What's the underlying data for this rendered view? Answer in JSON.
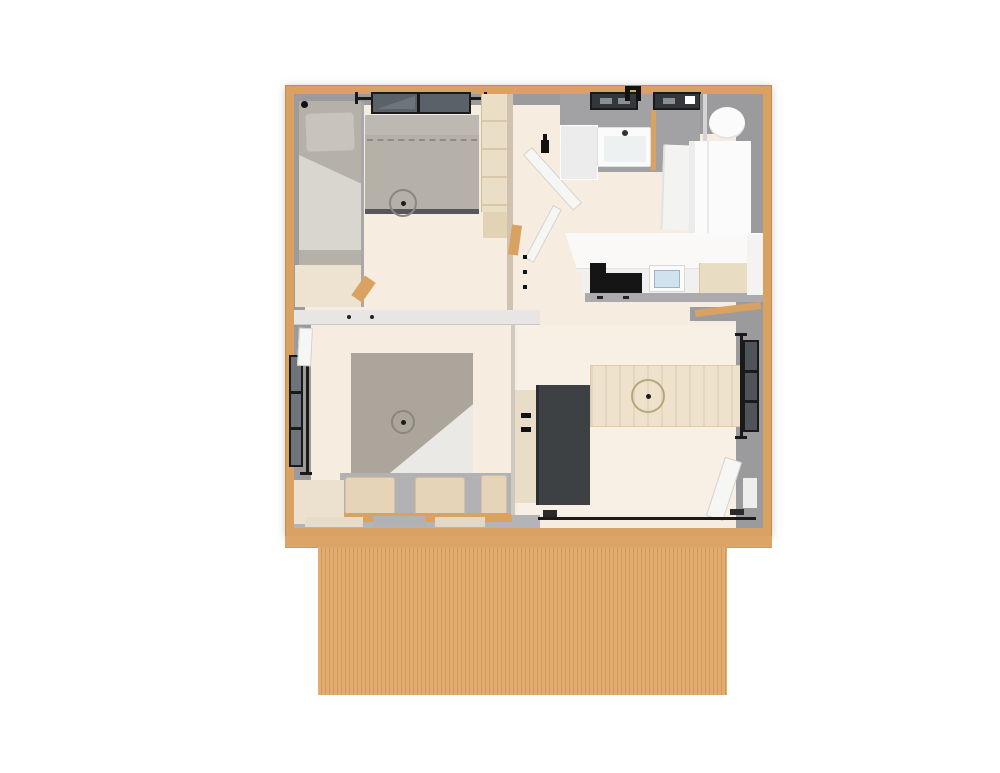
{
  "scene": {
    "type": "3d-floorplan-top-down-render",
    "description": "Top-down 3D rendered floor plan of a small two-bedroom cabin with bathroom, kitchen, living-dining area and a wooden plank deck along the front",
    "view": "top-down",
    "background": "#ffffff"
  },
  "palette": {
    "bg": "#ffffff",
    "wood-frame": "#d9a262",
    "wood-strip": "#dba567",
    "wood-deck": "#e2ac6e",
    "wood-deck-line": "#d09a5c",
    "wood-light": "#ebdec6",
    "floor-cream": "#f6ecdf",
    "floor-light": "#f8efe5",
    "wall-gray": "#9b9b9d",
    "wall-gray-light": "#b4b4b6",
    "divider-white": "#e7e6e4",
    "bed-gray": "#b5b0a8",
    "bed-gray-light": "#c8c4bd",
    "bed-sheet": "#d9d6d0",
    "taupe-bed": "#aca59c",
    "sheet-white": "#ebe9e5",
    "charcoal": "#3e4144",
    "black": "#1a1a1a",
    "glass-dark": "#5a6169",
    "glass-window": "#33373c",
    "glass-side": "#6e747a",
    "white-fixture": "#fbfbfb",
    "fixture-shade": "#ececea",
    "door-white": "#f6f6f4",
    "tan-pillow": "#e5d4b8",
    "tan-pillow-edge": "#d3c0a0",
    "sink-blue": "#cfe2ed",
    "counter-white": "#faf9f7",
    "counter-base": "#ababad",
    "light-ring": "#8b8680",
    "table-wood": "#eee2cc",
    "table-ring": "#b7a77f",
    "bed-frame-dark": "#54575b"
  },
  "building": {
    "deck": {
      "material": "wood",
      "planks": "vertical"
    },
    "rooms": [
      {
        "id": "bedroom-1",
        "position": "top-left",
        "furniture": [
          "single-bed",
          "double-bed",
          "window-above-bed",
          "wardrobe",
          "dresser-bench",
          "ceiling-light",
          "wall-lamp"
        ]
      },
      {
        "id": "bedroom-2",
        "position": "bottom-left",
        "furniture": [
          "double-bed",
          "white-sheet",
          "two-pillows",
          "headboard-rail",
          "side-bench",
          "left-window",
          "ceiling-light",
          "white-door-panel"
        ]
      },
      {
        "id": "hallway",
        "position": "center",
        "furniture": [
          "open-door-panels",
          "wall-lamp",
          "light-switches"
        ]
      },
      {
        "id": "bathroom",
        "position": "top-center",
        "furniture": [
          "washbasin",
          "shower-tray",
          "two-windows",
          "roof-fixture"
        ]
      },
      {
        "id": "toilet-corner",
        "position": "top-right",
        "furniture": [
          "toilet",
          "tall-white-cabinet",
          "refrigerator"
        ]
      },
      {
        "id": "kitchen",
        "position": "right",
        "furniture": [
          "counter",
          "cooktop",
          "kitchen-sink",
          "wood-worktop",
          "base-cabinets"
        ]
      },
      {
        "id": "living-dining",
        "position": "bottom-right",
        "furniture": [
          "dining-table",
          "pendant-light",
          "dark-cabinet",
          "cabinet-handles",
          "right-window",
          "entry-door",
          "sliding-glass-door",
          "benches"
        ]
      }
    ]
  }
}
